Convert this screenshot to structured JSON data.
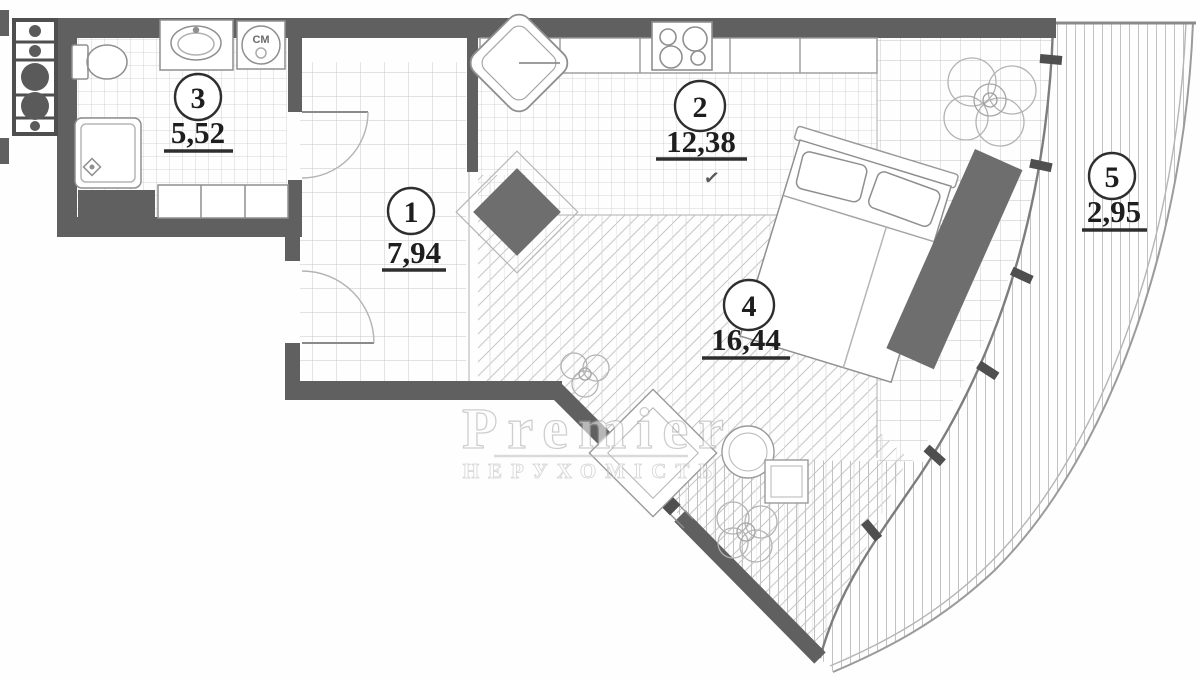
{
  "watermark": {
    "brand": "Premier",
    "tagline": "НЕРУХОМІСТЬ"
  },
  "rooms": [
    {
      "id": "1",
      "area": "7,94"
    },
    {
      "id": "2",
      "area": "12,38"
    },
    {
      "id": "3",
      "area": "5,52"
    },
    {
      "id": "4",
      "area": "16,44"
    },
    {
      "id": "5",
      "area": "2,95"
    }
  ],
  "annotations": {
    "washing_machine": "СМ",
    "checkmark": "✓"
  },
  "colors": {
    "wall": "#606060",
    "line": "#9a9a9a",
    "floor_line": "#c7c7c7",
    "ink": "#1e1e1e"
  }
}
